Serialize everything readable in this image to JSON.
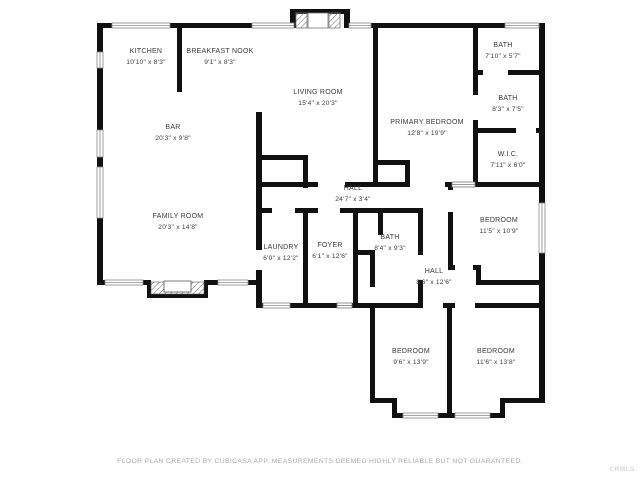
{
  "rooms": [
    {
      "name": "KITCHEN",
      "dims": "10'10\" x 8'3\"",
      "x": 146,
      "y": 57
    },
    {
      "name": "BREAKFAST NOOK",
      "dims": "9'1\" x 8'3\"",
      "x": 220,
      "y": 57
    },
    {
      "name": "LIVING ROOM",
      "dims": "15'4\" x 20'3\"",
      "x": 318,
      "y": 98
    },
    {
      "name": "BAR",
      "dims": "20'3\" x 9'8\"",
      "x": 173,
      "y": 133
    },
    {
      "name": "PRIMARY BEDROOM",
      "dims": "12'8\" x 19'9\"",
      "x": 427,
      "y": 128
    },
    {
      "name": "BATH",
      "dims": "7'10\" x 5'7\"",
      "x": 503,
      "y": 51
    },
    {
      "name": "BATH",
      "dims": "8'3\" x 7'5\"",
      "x": 508,
      "y": 104
    },
    {
      "name": "W.I.C.",
      "dims": "7'11\" x 6'0\"",
      "x": 508,
      "y": 160
    },
    {
      "name": "FAMILY ROOM",
      "dims": "20'3\" x 14'8\"",
      "x": 178,
      "y": 222
    },
    {
      "name": "HALL",
      "dims": "24'7\" x 3'4\"",
      "x": 353,
      "y": 194
    },
    {
      "name": "BEDROOM",
      "dims": "11'5\" x 10'9\"",
      "x": 499,
      "y": 226
    },
    {
      "name": "LAUNDRY",
      "dims": "6'0\" x 12'2\"",
      "x": 281,
      "y": 253
    },
    {
      "name": "FOYER",
      "dims": "6'1\" x 12'6\"",
      "x": 330,
      "y": 251
    },
    {
      "name": "BATH",
      "dims": "8'4\" x 9'3\"",
      "x": 390,
      "y": 243
    },
    {
      "name": "HALL",
      "dims": "8'6\" x 12'6\"",
      "x": 434,
      "y": 277
    },
    {
      "name": "BEDROOM",
      "dims": "9'6\" x 13'9\"",
      "x": 411,
      "y": 357
    },
    {
      "name": "BEDROOM",
      "dims": "11'6\" x 13'8\"",
      "x": 496,
      "y": 357
    }
  ],
  "footer": {
    "disclaimer": "FLOOR PLAN CREATED BY CUBICASA APP. MEASUREMENTS DEEMED HIGHLY RELIABLE BUT NOT GUARANTEED."
  },
  "watermark": "CRMLS",
  "colors": {
    "wall": "#111111",
    "label": "#3a3a3a",
    "footer": "#aaaaaa",
    "watermark": "#d9d9d9"
  }
}
